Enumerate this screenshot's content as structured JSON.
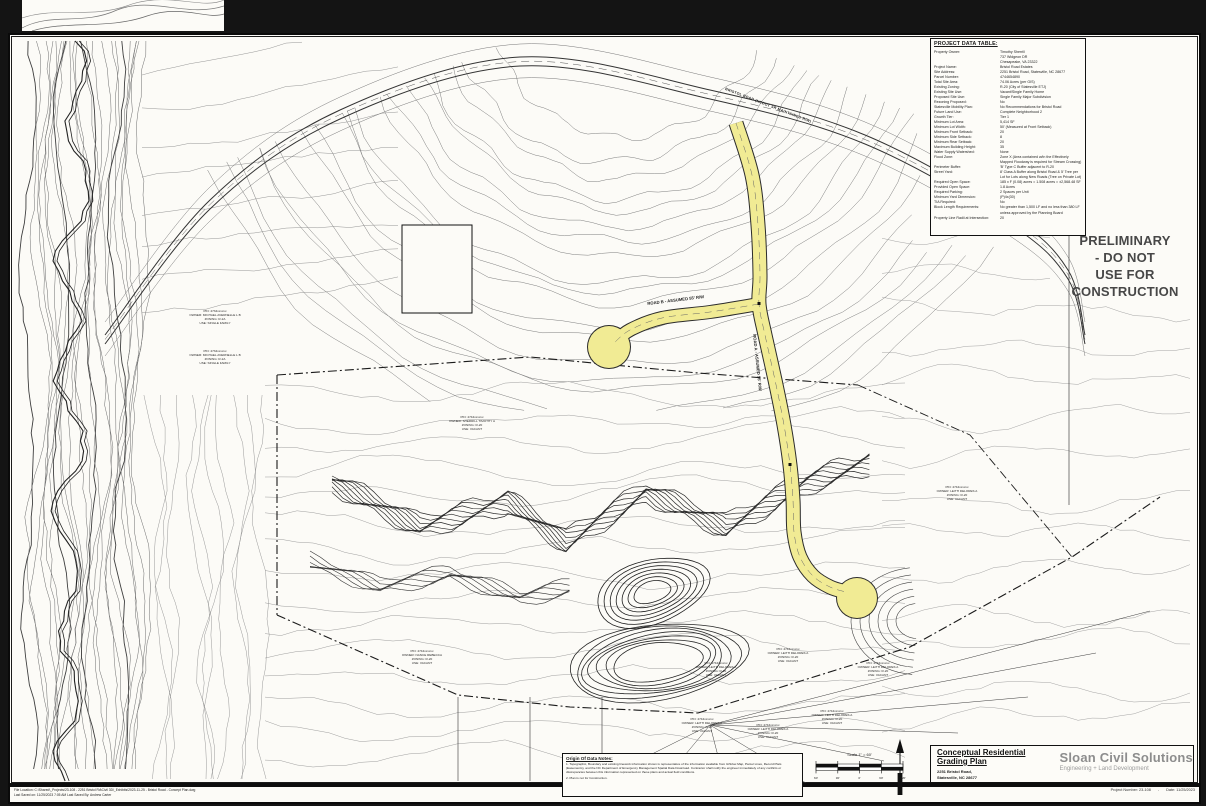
{
  "stamp": {
    "line1": "PRELIMINARY",
    "line2": "- DO NOT",
    "line3": "USE FOR",
    "line4": "CONSTRUCTION"
  },
  "project_table": {
    "title": "PROJECT DATA TABLE:",
    "rows": [
      {
        "label": "Property Owner:",
        "value": "Timothy Sherrill"
      },
      {
        "label": "",
        "value": "737 Widgeon DR"
      },
      {
        "label": "",
        "value": "Chesapeake, VA 23322"
      },
      {
        "label": "Project Name:",
        "value": "Bristol Road Estates"
      },
      {
        "label": "Site Address:",
        "value": "2251 Bristol Road, Statesville, NC 28677"
      },
      {
        "label": "Parcel Number:",
        "value": "4744654890"
      },
      {
        "label": "Total Site Area:",
        "value": "74.06 Acres (per GIS)"
      },
      {
        "label": "Existing Zoning:",
        "value": "R-20 (City of Statesville ETJ)"
      },
      {
        "label": "Existing Site Use:",
        "value": "Vacant/Single Family Home"
      },
      {
        "label": "Proposed Site Use:",
        "value": "Single Family Major Subdivision"
      },
      {
        "label": "Rezoning Proposed:",
        "value": "No"
      },
      {
        "label": "Statesville Mobility Plan:",
        "value": "No Recommendations for Bristol Road"
      },
      {
        "label": "Future Land Use:",
        "value": "Complete Neighborhood 2"
      },
      {
        "label": "Growth Tier:",
        "value": "Tier 1"
      },
      {
        "label": "Minimum Lot Area:",
        "value": "5,414 SF"
      },
      {
        "label": "Minimum Lot Width:",
        "value": "50' (Measured at Front Setback)"
      },
      {
        "label": "Minimum Front Setback:",
        "value": "20"
      },
      {
        "label": "Minimum Side Setback:",
        "value": "8"
      },
      {
        "label": "Minimum Rear Setback:",
        "value": "20"
      },
      {
        "label": "Maximum Building Height:",
        "value": "35"
      },
      {
        "label": "Water Supply Watershed:",
        "value": "None"
      },
      {
        "label": "Flood Zone:",
        "value": "Zone X (Area contained w/in the Effectively Mapped Floodway is required for Stream Crossing)"
      },
      {
        "label": "Perimeter Buffer:",
        "value": "'B' Type C Buffer adjacent to R-20"
      },
      {
        "label": "Street Yard:",
        "value": "8' Class A Buffer along Bristol Road & 5' Tree per Lot for Lots along New Roads (Tree on Private Lot)"
      },
      {
        "label": "Required Open Space:",
        "value": "185 x F (0.08) acres = 1.508 acres = ±2,568.48 SF"
      },
      {
        "label": "Provided Open Space:",
        "value": "1.8 Acres"
      },
      {
        "label": "Required Parking:",
        "value": "2 Spaces per Unit"
      },
      {
        "label": "Minimum Yard Dimension:",
        "value": "(P)4x(30)"
      },
      {
        "label": "TIA Required:",
        "value": "No"
      },
      {
        "label": "Block Length Requirements:",
        "value": "No greater than 1,500 LF and no less than 380 LF unless approved by the Planning Board"
      },
      {
        "label": "Property Line Radii at Intersection:",
        "value": "20"
      }
    ]
  },
  "roads": {
    "road_a_label": "ROAD A - ASSUMED 55' R/W",
    "road_b_label": "ROAD B - ASSUMED 55' R/W",
    "bristol_label": "BRISTOL ROAD (NCDOT SR MAINTAINED R/W)"
  },
  "parcels": [
    {
      "lines": [
        "PIN: 4734xxxxxx",
        "OWNER: MICHAEL AVERNELLE L B",
        "ZONING: R-2A",
        "USE: SINGLE FAMILY"
      ]
    },
    {
      "lines": [
        "PIN: 4734xxxxxx",
        "OWNER: MICHAEL AVERNELLE L B",
        "ZONING: R-2A",
        "USE: SINGLE FAMILY"
      ]
    },
    {
      "lines": [
        "PIN: 4744xxxxxx",
        "OWNER: SHERRILL TIMOTHY A",
        "ZONING: R-20",
        "USE: VACANT"
      ]
    },
    {
      "lines": [
        "PIN: 4744xxxxxx",
        "OWNER: LEITH DELORES A",
        "ZONING: R-20",
        "USE: VACANT"
      ]
    },
    {
      "lines": [
        "PIN: 4744xxxxxx",
        "OWNER: NANCE REBECCA",
        "ZONING: R-20",
        "USE: VACANT"
      ]
    },
    {
      "lines": [
        "PIN: 4744xxxxxx",
        "OWNER: LEITH DELORES A",
        "ZONING: R-20",
        "USE: VACANT"
      ]
    },
    {
      "lines": [
        "PIN: 4744xxxxxx",
        "OWNER: LEITH DELORES A",
        "ZONING: R-20",
        "USE: VACANT"
      ]
    },
    {
      "lines": [
        "PIN: 4744xxxxxx",
        "OWNER: LEITH DELORES A",
        "ZONING: R-20",
        "USE: VACANT"
      ]
    },
    {
      "lines": [
        "PIN: 4744xxxxxx",
        "OWNER: LEITH DELORES A",
        "ZONING: R-20",
        "USE: VACANT"
      ]
    },
    {
      "lines": [
        "PIN: 4744xxxxxx",
        "OWNER: LEITH DELORES A",
        "ZONING: R-20",
        "USE: VACANT"
      ]
    },
    {
      "lines": [
        "PIN: 4744xxxxxx",
        "OWNER: LEITH DELORES A",
        "ZONING: R-20",
        "USE: VACANT"
      ]
    }
  ],
  "notes": {
    "title": "Origin Of Data Notes:",
    "items": [
      "1.  Topographic, Boundary and existing linework information shown is representative of the information available from GIS/tax Map, Parcel Lines, Record Plats (Easements), and the NC Department of Emergency Management Spatial Data Download. Contractor shall notify the engineer immediately of any conflicts or discrepancies between this information represented on these plans and actual field conditions.",
      "2.  Plan is not for Construction."
    ]
  },
  "scale": {
    "label": "Scale 1\" = 60'",
    "ticks": [
      "60'",
      "30'",
      "0'",
      "60'",
      "120'"
    ]
  },
  "north": {
    "letter": "N"
  },
  "title_block": {
    "plan_title_line1": "Conceptual Residential",
    "plan_title_line2": "Grading Plan",
    "address_line1": "2251 Bristol Road,",
    "address_line2": "Statesville, NC 28677",
    "firm_name": "Sloan Civil Solutions",
    "firm_tagline": "Engineering + Land Development"
  },
  "footer": {
    "project_number": "Project Number: 23-108",
    "separator": "-",
    "date": "Date: 11/25/2023",
    "file_line": "File Location: C:\\Shared\\_Projects\\23-108 - 2251 Bristol Rd\\Civil 3D\\_Exhibits\\2023-11-25 - Bristol Road - Concept Plan.dwg",
    "saved_line": "Last Saved on: 11/25/2023 7:05 AM     Last Saved By: Andrew Carter"
  },
  "colors": {
    "background": "#141414",
    "sheet": "#fcfbf7",
    "road_highlight": "#f1eb94",
    "stamp_text": "#474747",
    "firm_gray": "#8d8d8d"
  }
}
